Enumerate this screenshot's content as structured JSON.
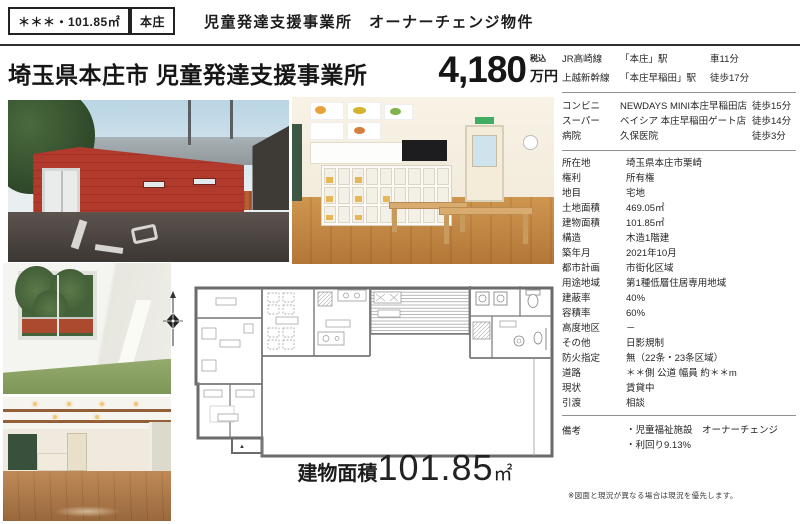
{
  "header": {
    "badge_area": "＊＊＊・101.85㎡",
    "badge_city": "本庄",
    "title": "児童発達支援事業所　オーナーチェンジ物件"
  },
  "listing": {
    "title": "埼玉県本庄市 児童発達支援事業所",
    "price_value": "4,180",
    "price_tax_note": "税込",
    "price_unit": "万円"
  },
  "access": {
    "rows": [
      {
        "label": "JR高崎線",
        "value": "「本庄」駅",
        "note": "車11分"
      },
      {
        "label": "上越新幹線",
        "value": "「本庄早稲田」駅",
        "note": "徒歩17分"
      }
    ]
  },
  "facilities": {
    "rows": [
      {
        "label": "コンビニ",
        "value": "NEWDAYS MINI本庄早稲田店",
        "note": "徒歩15分"
      },
      {
        "label": "スーパー",
        "value": "ベイシア 本庄早稲田ゲート店",
        "note": "徒歩14分"
      },
      {
        "label": "病院",
        "value": "久保医院",
        "note": "徒歩3分"
      }
    ]
  },
  "details": {
    "rows": [
      {
        "label": "所在地",
        "value": "埼玉県本庄市栗崎"
      },
      {
        "label": "権利",
        "value": "所有権"
      },
      {
        "label": "地目",
        "value": "宅地"
      },
      {
        "label": "土地面積",
        "value": "469.05㎡"
      },
      {
        "label": "建物面積",
        "value": "101.85㎡"
      },
      {
        "label": "構造",
        "value": "木造1階建"
      },
      {
        "label": "築年月",
        "value": "2021年10月"
      },
      {
        "label": "都市計画",
        "value": "市街化区域"
      },
      {
        "label": "用途地域",
        "value": "第1種低層住居専用地域"
      },
      {
        "label": "建蔽率",
        "value": "40%"
      },
      {
        "label": "容積率",
        "value": "60%"
      },
      {
        "label": "高度地区",
        "value": "－"
      },
      {
        "label": "その他",
        "value": "日影規制"
      },
      {
        "label": "防火指定",
        "value": "無（22条・23条区域）"
      },
      {
        "label": "道路",
        "value": "＊＊側 公道 幅員 約＊＊m"
      },
      {
        "label": "現状",
        "value": "賃貸中"
      },
      {
        "label": "引渡",
        "value": "相談"
      }
    ]
  },
  "remarks": {
    "label": "備考",
    "lines": [
      "・児童福祉施設　オーナーチェンジ",
      "・利回り9.13%"
    ]
  },
  "floor_plan": {
    "area_label": "建物面積",
    "area_value": "101.85",
    "area_unit": "㎡",
    "entrance_marker": "▲"
  },
  "footnote": "※図面と現況が異なる場合は現況を優先します。"
}
